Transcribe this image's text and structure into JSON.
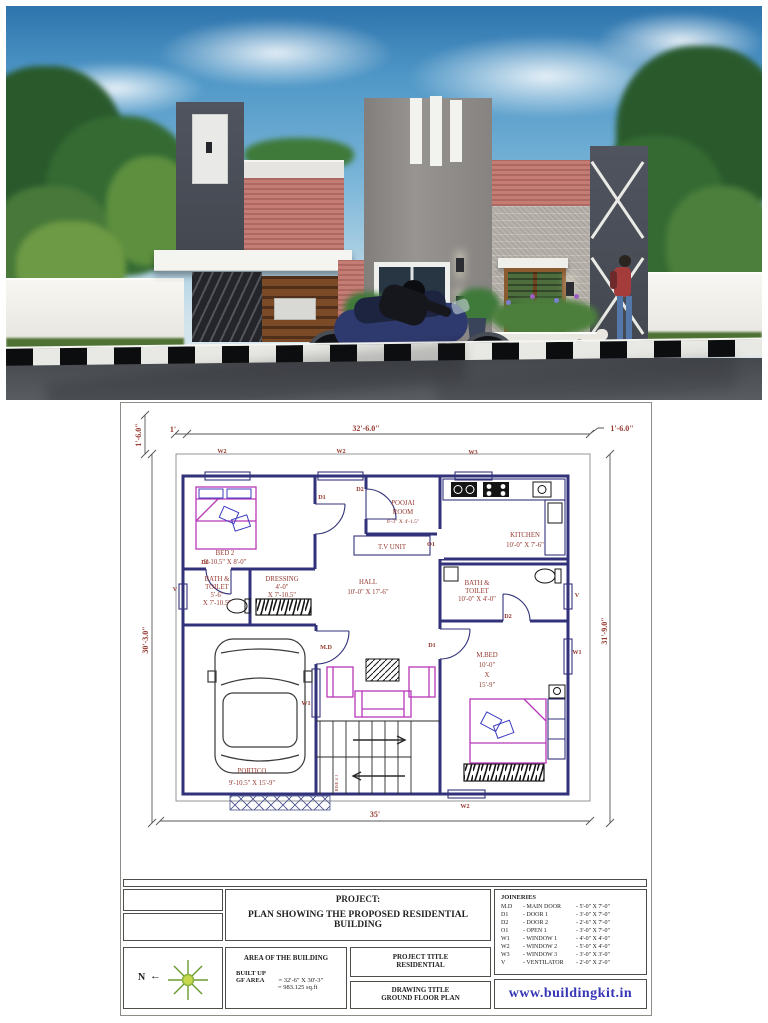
{
  "colors": {
    "wall_line": "#32327a",
    "furniture_magenta": "#b837b8",
    "label_red": "#953a30",
    "website_blue": "#3535b5",
    "render_red_wall": "#c0746c",
    "render_dark_block": "#4a4e59"
  },
  "plan": {
    "dims": {
      "top": "32'-6.0\"",
      "top_left": "1'",
      "top_right": "1'-6.0\"",
      "left_offset": "1'-6.0\"",
      "left": "30'-3.0\"",
      "right": "31'-9.0\"",
      "bottom": "35'"
    },
    "marks": {
      "w1": "W1",
      "w2": "W2",
      "w3": "W3",
      "v": "V",
      "d1": "D1",
      "d2": "D2",
      "md": "M.D",
      "o1": "O1"
    },
    "rooms": {
      "bed2": [
        "BED 2",
        "9'-10.5\" X 8'-0\""
      ],
      "bath_left": [
        "BATH &",
        "TOILET",
        "5'-6\"",
        "X 7'-10.5\""
      ],
      "dressing": [
        "DRESSING",
        "4'-0\"",
        "X 7'-10.5\""
      ],
      "poojai": [
        "POOJAI",
        "ROOM",
        "6'-3\" X 4'-1.5\""
      ],
      "tv_unit": "T.V UNIT",
      "kitchen": [
        "KITCHEN",
        "10'-0\" X 7'-6\""
      ],
      "hall": [
        "HALL",
        "10'-0\" X 17'-6\""
      ],
      "bath_right": [
        "BATH &",
        "TOILET",
        "10'-0\" X 4'-0\""
      ],
      "mbed": [
        "M.BED",
        "10'-0\"",
        "X",
        "15'-9\""
      ],
      "portico": [
        "PORTICO",
        "9'-10.5\" X 15'-9\""
      ],
      "stair": "RISE # 1"
    }
  },
  "title_block": {
    "project_heading": "PROJECT:",
    "project_name_line1": "PLAN SHOWING THE PROPOSED RESIDENTIAL",
    "project_name_line2": "BUILDING",
    "area_heading": "AREA OF THE BUILDING",
    "built_up": "BUILT UP",
    "gf_area_label": "GF AREA",
    "gf_area_value": "= 32'-6\" X 30'-3\"",
    "gf_area_total": "= 983.125 sq.ft",
    "project_title_label": "PROJECT TITLE",
    "project_title_value": "RESIDENTIAL",
    "drawing_title_label": "DRAWING TITLE",
    "drawing_title_value": "GROUND FLOOR PLAN",
    "joineries_heading": "JOINERIES",
    "joineries": [
      {
        "code": "M.D",
        "name": "- MAIN DOOR",
        "size": "- 5'-0\" X 7'-0\""
      },
      {
        "code": "D1",
        "name": "- DOOR 1",
        "size": "- 3'-0\" X 7'-0\""
      },
      {
        "code": "D2",
        "name": "- DOOR 2",
        "size": "- 2'-6\" X 7'-0\""
      },
      {
        "code": "O1",
        "name": "- OPEN 1",
        "size": "- 3'-0\" X 7'-0\""
      },
      {
        "code": "W1",
        "name": "- WINDOW 1",
        "size": "- 4'-0\" X 4'-0\""
      },
      {
        "code": "W2",
        "name": "- WINDOW 2",
        "size": "- 5'-0\" X 4'-0\""
      },
      {
        "code": "W3",
        "name": "- WINDOW 3",
        "size": "- 3'-0\" X 3'-0\""
      },
      {
        "code": "V",
        "name": "- VENTILATOR",
        "size": "- 2'-0\" X 2'-0\""
      }
    ],
    "north_label": "N",
    "website": "www.buildingkit.in"
  }
}
